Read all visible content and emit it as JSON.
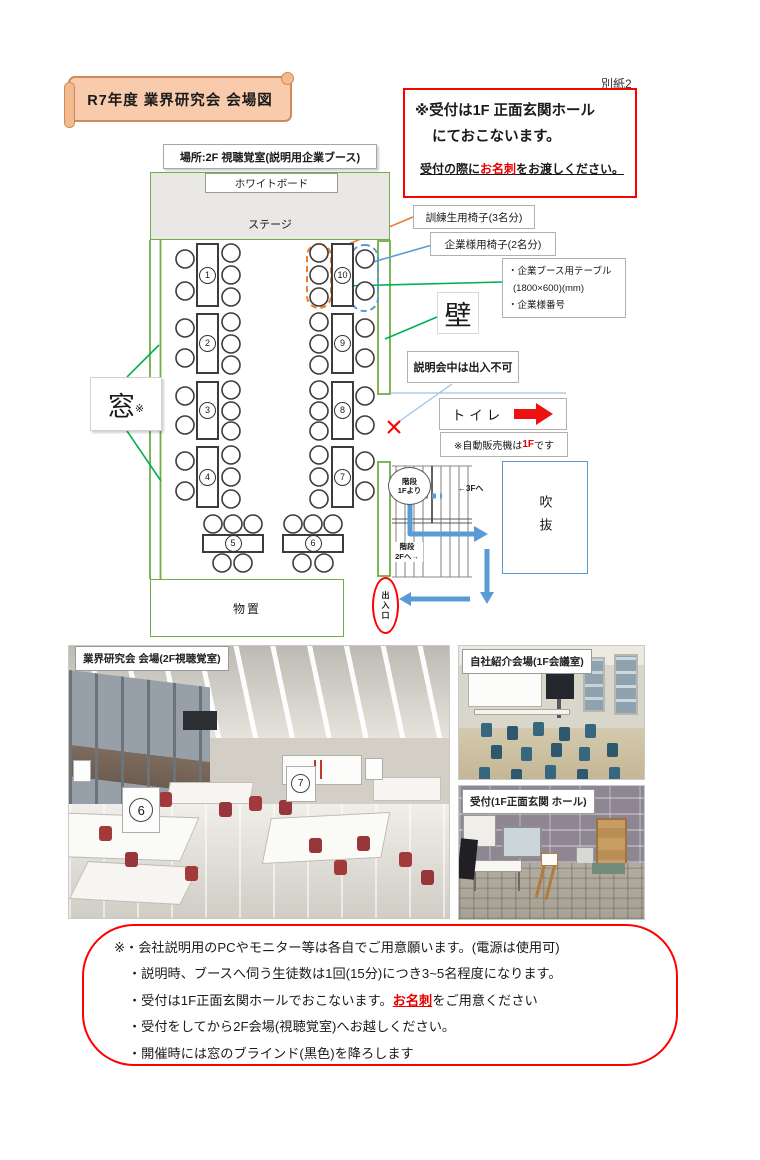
{
  "doc": {
    "attachment": "別紙2"
  },
  "title": {
    "banner": "R7年度 業界研究会 会場図"
  },
  "reception_notice": {
    "line1": "※受付は1F 正面玄関ホール",
    "line2": "にておこないます。",
    "line3_prefix": "受付の際に",
    "line3_em": "お名刺",
    "line3_suffix": "をお渡しください。"
  },
  "location": {
    "label": "場所:2F 視聴覚室(説明用企業ブース)"
  },
  "plan": {
    "whiteboard": "ホワイトボード",
    "stage": "ステージ",
    "window": "窓",
    "window_mark": "※",
    "wall": "壁",
    "no_entry": "説明会中は出入不可",
    "toilet": "トイレ",
    "vending_prefix": "※自動販売機は",
    "vending_em": "1F",
    "vending_suffix": "です",
    "storage": "物置",
    "exit": "出入口",
    "atrium": "吹抜",
    "stairs_bubble_l1": "階段",
    "stairs_bubble_l2": "1Fより",
    "to_3f": "←3Fへ",
    "stairs_2f_l1": "階段",
    "stairs_2f_l2": "2Fへ→",
    "legend_trainee": "訓練生用椅子(3名分)",
    "legend_company": "企業様用椅子(2名分)",
    "legend_booth_l1": "・企業ブース用テーブル",
    "legend_booth_l2": "(1800×600)(mm)",
    "legend_booth_l3": "・企業様番号",
    "tables": [
      "1",
      "2",
      "3",
      "4",
      "5",
      "6",
      "7",
      "8",
      "9",
      "10"
    ]
  },
  "photos": {
    "p1_caption": "業界研究会 会場(2F視聴覚室)",
    "p1_sign_a": "6",
    "p1_sign_b": "7",
    "p2_caption": "自社紹介会場(1F会議室)",
    "p3_caption": "受付(1F正面玄関 ホール)"
  },
  "notes": {
    "l1": "※・会社説明用のPCやモニター等は各自でご用意願います。(電源は使用可)",
    "l2": "・説明時、ブースへ伺う生徒数は1回(15分)につき3~5名程度になります。",
    "l3_prefix": "・受付は1F正面玄関ホールでおこないます。",
    "l3_em": "お名刺",
    "l3_suffix": "をご用意ください",
    "l4": "・受付をしてから2F会場(視聴覚室)へお越しください。",
    "l5": "・開催時には窓のブラインド(黒色)を降ろします"
  },
  "colors": {
    "plan_green": "#70ad47",
    "leader_green": "#00b050",
    "accent_orange": "#ed7d31",
    "accent_blue": "#5b9bd5",
    "alert_red": "#ff0000"
  }
}
